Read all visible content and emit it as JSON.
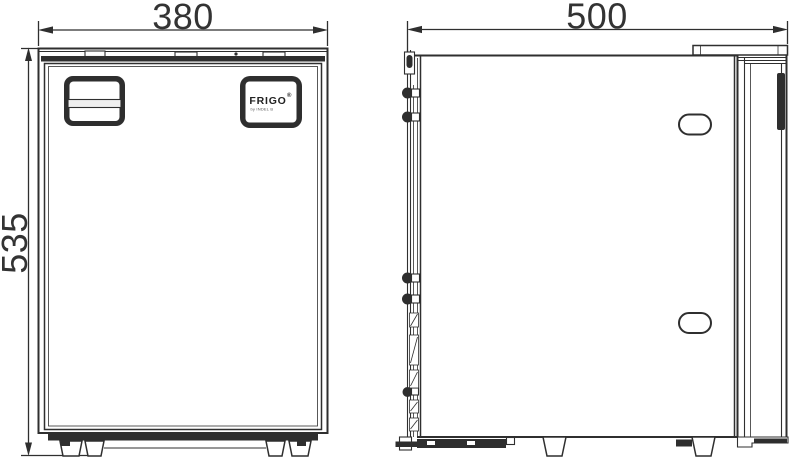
{
  "drawing": {
    "front_view": {
      "width_mm": "380",
      "height_mm": "535"
    },
    "side_view": {
      "depth_mm": "500"
    },
    "logo": {
      "brand": "FRIGO",
      "mark": "®",
      "subtext": "by INDEL B"
    },
    "colors": {
      "line": "#2f2f2f",
      "dark_fill": "#2e2e2e",
      "background": "#ffffff"
    }
  }
}
